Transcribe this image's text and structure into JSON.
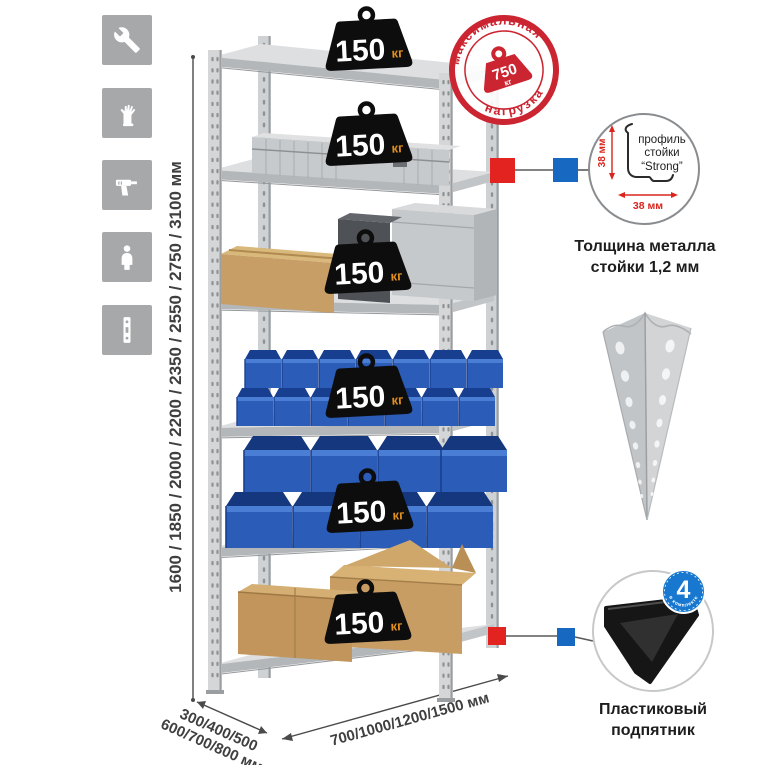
{
  "colors": {
    "stamp_red": "#cb2531",
    "connector_red": "#e3231f",
    "connector_blue": "#1668c0",
    "bin_blue": "#2a5cb8",
    "badge_black": "#0d0d0d",
    "badge_unit_orange": "#e18f1f",
    "metal_gray": "#d2d4d6",
    "icon_box_gray": "#a7a8aa"
  },
  "sidebar": {
    "icons": [
      {
        "name": "wrench-icon"
      },
      {
        "name": "gloves-icon"
      },
      {
        "name": "drill-icon"
      },
      {
        "name": "person-icon"
      },
      {
        "name": "perforated-strip-icon"
      }
    ]
  },
  "dimensions": {
    "height": "1600 / 1850 / 2000 / 2200 / 2350 / 2550 / 2750 / 3100 мм",
    "depth_line1": "300/400/500",
    "depth_line2": "600/700/800 мм",
    "width": "700/1000/1200/1500 мм"
  },
  "shelf_badges": [
    {
      "value": "150",
      "unit": "кг"
    },
    {
      "value": "150",
      "unit": "кг"
    },
    {
      "value": "150",
      "unit": "кг"
    },
    {
      "value": "150",
      "unit": "кг"
    },
    {
      "value": "150",
      "unit": "кг"
    },
    {
      "value": "150",
      "unit": "кг"
    }
  ],
  "stamp": {
    "arc_top": "максимальная",
    "arc_bottom": "нагрузка",
    "value": "750",
    "unit": "кг"
  },
  "profile_feature": {
    "label_l1": "профиль",
    "label_l2": "стойки",
    "label_l3": "“Strong”",
    "dim_v": "38 мм",
    "dim_h": "38 мм",
    "caption_l1": "Толщина металла",
    "caption_l2": "стойки 1,2 мм"
  },
  "foot_feature": {
    "badge_number": "4",
    "badge_ring_text": "в комплекте",
    "caption_l1": "Пластиковый",
    "caption_l2": "подпятник"
  }
}
